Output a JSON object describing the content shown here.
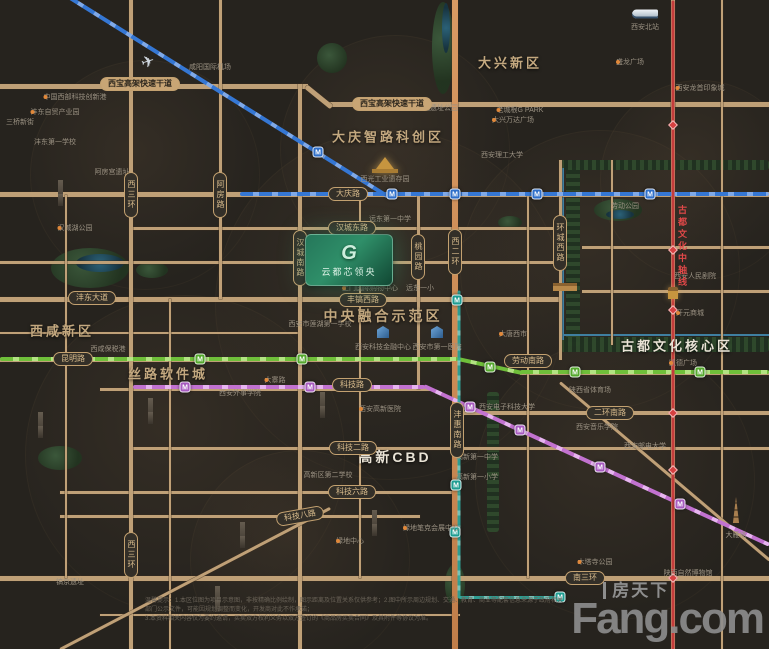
{
  "project": {
    "name": "云都芯领央",
    "emblem": "G"
  },
  "watermark": {
    "cn": "房天下",
    "en": "Fang.com"
  },
  "axis": {
    "label": "古都文化中轴线"
  },
  "disclaimer": {
    "line1": "温馨提示：1.本区位图为项目示意图，非按精确比例绘制，图示距离及位置关系仅供参考；2.图中所示周边规划、交通、教育、商业等配套信息来源于政府相关部门公示文件，可能因规划调整而变化，开发商对此不作承诺；",
    "line2": "3.本资料相关内容仅为要约邀请，买卖双方权利义务以双方签订的《商品房买卖合同》及其附件等协议为准。"
  },
  "map": {
    "bubbles": [
      {
        "x": 390,
        "y": 305,
        "r": 175
      },
      {
        "x": 185,
        "y": 455,
        "r": 160
      },
      {
        "x": 395,
        "y": 150,
        "r": 115
      },
      {
        "x": 600,
        "y": 270,
        "r": 140
      },
      {
        "x": 615,
        "y": 480,
        "r": 140
      },
      {
        "x": 145,
        "y": 175,
        "r": 115
      },
      {
        "x": 300,
        "y": 560,
        "r": 110
      },
      {
        "x": 700,
        "y": 180,
        "r": 100
      }
    ],
    "parks": [
      {
        "x": 90,
        "y": 268,
        "w": 78,
        "h": 40
      },
      {
        "x": 152,
        "y": 270,
        "w": 32,
        "h": 16
      },
      {
        "x": 332,
        "y": 58,
        "w": 30,
        "h": 30
      },
      {
        "x": 443,
        "y": 48,
        "w": 22,
        "h": 92
      },
      {
        "x": 510,
        "y": 222,
        "w": 24,
        "h": 13
      },
      {
        "x": 618,
        "y": 210,
        "w": 48,
        "h": 22
      },
      {
        "x": 60,
        "y": 458,
        "w": 44,
        "h": 24
      },
      {
        "x": 455,
        "y": 585,
        "w": 20,
        "h": 42
      }
    ],
    "bands": [
      {
        "x": 566,
        "y": 168,
        "w": 14,
        "h": 178,
        "v": true
      },
      {
        "x": 560,
        "y": 337,
        "w": 209,
        "h": 15
      },
      {
        "x": 560,
        "y": 160,
        "w": 209,
        "h": 10
      },
      {
        "x": 487,
        "y": 392,
        "w": 12,
        "h": 140,
        "v": true
      }
    ],
    "water": [
      {
        "x": 100,
        "y": 263,
        "w": 48,
        "h": 18
      },
      {
        "x": 620,
        "y": 214,
        "w": 28,
        "h": 9
      },
      {
        "x": 446,
        "y": 28,
        "w": 8,
        "h": 50
      }
    ],
    "moat": [
      {
        "x": 562,
        "y": 168,
        "w": 2,
        "h": 172
      },
      {
        "x": 560,
        "y": 334,
        "w": 209,
        "h": 2
      }
    ],
    "roads_h": [
      {
        "y": 86,
        "x1": 0,
        "x2": 308,
        "w": 5
      },
      {
        "y": 104,
        "x1": 328,
        "x2": 769,
        "w": 5
      },
      {
        "y": 194,
        "x1": 0,
        "x2": 769,
        "w": 5
      },
      {
        "y": 228,
        "x1": 131,
        "x2": 560,
        "w": 3
      },
      {
        "y": 262,
        "x1": 0,
        "x2": 560,
        "w": 3
      },
      {
        "y": 299,
        "x1": 0,
        "x2": 560,
        "w": 5
      },
      {
        "y": 247,
        "x1": 582,
        "x2": 769,
        "w": 3
      },
      {
        "y": 291,
        "x1": 582,
        "x2": 769,
        "w": 3
      },
      {
        "y": 360,
        "x1": 0,
        "x2": 460,
        "w": 4
      },
      {
        "y": 373,
        "x1": 520,
        "x2": 769,
        "w": 4
      },
      {
        "y": 389,
        "x1": 100,
        "x2": 432,
        "w": 3
      },
      {
        "y": 413,
        "x1": 455,
        "x2": 769,
        "w": 4
      },
      {
        "y": 448,
        "x1": 131,
        "x2": 769,
        "w": 3
      },
      {
        "y": 492,
        "x1": 60,
        "x2": 460,
        "w": 3
      },
      {
        "y": 516,
        "x1": 60,
        "x2": 420,
        "w": 3
      },
      {
        "y": 578,
        "x1": 0,
        "x2": 769,
        "w": 5
      },
      {
        "y": 615,
        "x1": 100,
        "x2": 460,
        "w": 2
      },
      {
        "y": 333,
        "x1": 0,
        "x2": 300,
        "w": 2
      }
    ],
    "roads_v": [
      {
        "x": 66,
        "y1": 195,
        "y2": 578,
        "w": 2
      },
      {
        "x": 131,
        "y1": 0,
        "y2": 649,
        "w": 4
      },
      {
        "x": 220,
        "y1": 0,
        "y2": 299,
        "w": 3
      },
      {
        "x": 300,
        "y1": 84,
        "y2": 649,
        "w": 4
      },
      {
        "x": 360,
        "y1": 194,
        "y2": 578,
        "w": 2
      },
      {
        "x": 418,
        "y1": 194,
        "y2": 389,
        "w": 3
      },
      {
        "x": 455,
        "y1": 0,
        "y2": 649,
        "w": 6,
        "cls": "orange"
      },
      {
        "x": 528,
        "y1": 194,
        "y2": 578,
        "w": 2
      },
      {
        "x": 560,
        "y1": 160,
        "y2": 360,
        "w": 3
      },
      {
        "x": 612,
        "y1": 160,
        "y2": 345,
        "w": 2
      },
      {
        "x": 673,
        "y1": 0,
        "y2": 649,
        "w": 4
      },
      {
        "x": 722,
        "y1": 0,
        "y2": 649,
        "w": 2
      },
      {
        "x": 170,
        "y1": 299,
        "y2": 649,
        "w": 2
      }
    ],
    "roads_d": [
      {
        "x": 306,
        "y": 86,
        "len": 33,
        "ang": 39,
        "w": 5
      },
      {
        "x": 60,
        "y": 649,
        "len": 305,
        "ang": -27.6,
        "w": 3
      },
      {
        "x": 560,
        "y": 382,
        "len": 275,
        "ang": 40.3,
        "w": 3
      }
    ],
    "metro": [
      {
        "c": "blue",
        "x": 67,
        "y": -4,
        "len": 379,
        "ang": 32,
        "w": 4
      },
      {
        "c": "blue",
        "x": 240,
        "y": 194,
        "len": 529,
        "ang": 0,
        "w": 4
      },
      {
        "c": "green",
        "x": 0,
        "y": 359,
        "len": 458,
        "ang": 0,
        "w": 4
      },
      {
        "c": "green",
        "x": 458,
        "y": 359,
        "len": 66,
        "ang": 12.3,
        "w": 4
      },
      {
        "c": "green",
        "x": 520,
        "y": 372,
        "len": 249,
        "ang": 0,
        "w": 4
      },
      {
        "c": "pink",
        "x": 133,
        "y": 387,
        "len": 292,
        "ang": 0,
        "w": 4
      },
      {
        "c": "pink",
        "x": 424,
        "y": 386,
        "len": 380,
        "ang": 24.7,
        "w": 4
      },
      {
        "c": "teal",
        "x": 459,
        "y": 290,
        "len": 308,
        "ang": 90,
        "w": 3
      },
      {
        "c": "teal",
        "x": 459,
        "y": 597,
        "len": 106,
        "ang": 0,
        "w": 3
      },
      {
        "c": "red",
        "x": 673,
        "y": 0,
        "len": 649,
        "ang": 90,
        "w": 3
      }
    ],
    "stations": [
      {
        "c": "blue",
        "x": 318,
        "y": 152
      },
      {
        "c": "blue",
        "x": 392,
        "y": 194
      },
      {
        "c": "blue",
        "x": 455,
        "y": 194
      },
      {
        "c": "blue",
        "x": 537,
        "y": 194
      },
      {
        "c": "blue",
        "x": 650,
        "y": 194
      },
      {
        "c": "green",
        "x": 200,
        "y": 359
      },
      {
        "c": "green",
        "x": 302,
        "y": 359
      },
      {
        "c": "green",
        "x": 490,
        "y": 367
      },
      {
        "c": "green",
        "x": 575,
        "y": 372
      },
      {
        "c": "green",
        "x": 700,
        "y": 372
      },
      {
        "c": "teal",
        "x": 457,
        "y": 300
      },
      {
        "c": "teal",
        "x": 456,
        "y": 485
      },
      {
        "c": "teal",
        "x": 455,
        "y": 532
      },
      {
        "c": "teal",
        "x": 560,
        "y": 597
      },
      {
        "c": "pink",
        "x": 185,
        "y": 387
      },
      {
        "c": "pink",
        "x": 310,
        "y": 387
      },
      {
        "c": "pink",
        "x": 470,
        "y": 407
      },
      {
        "c": "pink",
        "x": 520,
        "y": 430
      },
      {
        "c": "pink",
        "x": 600,
        "y": 467
      },
      {
        "c": "pink",
        "x": 680,
        "y": 504
      }
    ],
    "red_stations": [
      {
        "x": 673,
        "y": 125
      },
      {
        "x": 673,
        "y": 250
      },
      {
        "x": 673,
        "y": 310
      },
      {
        "x": 673,
        "y": 413
      },
      {
        "x": 673,
        "y": 470
      },
      {
        "x": 673,
        "y": 578
      }
    ],
    "station_glyph": "M",
    "badges": [
      {
        "t": "西宝高架快速干道",
        "x": 140,
        "y": 84,
        "fill": true
      },
      {
        "t": "西宝高架快速干道",
        "x": 392,
        "y": 104,
        "fill": true
      },
      {
        "t": "大庆路",
        "x": 348,
        "y": 194
      },
      {
        "t": "汉城东路",
        "x": 352,
        "y": 228
      },
      {
        "t": "沣东大道",
        "x": 92,
        "y": 298
      },
      {
        "t": "丰镐西路",
        "x": 363,
        "y": 300
      },
      {
        "t": "昆明路",
        "x": 73,
        "y": 359
      },
      {
        "t": "劳动南路",
        "x": 528,
        "y": 361
      },
      {
        "t": "科技路",
        "x": 352,
        "y": 385
      },
      {
        "t": "科技二路",
        "x": 353,
        "y": 448
      },
      {
        "t": "科技六路",
        "x": 352,
        "y": 492
      },
      {
        "t": "科技八路",
        "x": 300,
        "y": 516,
        "rot": -10
      },
      {
        "t": "二环南路",
        "x": 610,
        "y": 413
      },
      {
        "t": "南三环",
        "x": 585,
        "y": 578
      },
      {
        "t": "西三环",
        "x": 131,
        "y": 195,
        "v": true
      },
      {
        "t": "西三环",
        "x": 131,
        "y": 555,
        "v": true
      },
      {
        "t": "阿房路",
        "x": 220,
        "y": 195,
        "v": true
      },
      {
        "t": "汉城南路",
        "x": 300,
        "y": 258,
        "v": true
      },
      {
        "t": "桃园路",
        "x": 418,
        "y": 257,
        "v": true
      },
      {
        "t": "西二环",
        "x": 455,
        "y": 252,
        "v": true
      },
      {
        "t": "沣惠南路",
        "x": 457,
        "y": 430,
        "v": true
      },
      {
        "t": "环城西路",
        "x": 560,
        "y": 243,
        "v": true
      }
    ],
    "districts": [
      {
        "t": "大兴新区",
        "x": 510,
        "y": 62,
        "s": 13
      },
      {
        "t": "大庆智路科创区",
        "x": 388,
        "y": 136,
        "s": 13
      },
      {
        "t": "西咸新区",
        "x": 62,
        "y": 330,
        "s": 13
      },
      {
        "t": "丝路软件城",
        "x": 168,
        "y": 373,
        "s": 13
      },
      {
        "t": "中央融合示范区",
        "x": 383,
        "y": 316,
        "s": 14
      },
      {
        "t": "高新CBD",
        "x": 395,
        "y": 457,
        "s": 14,
        "white": true
      },
      {
        "t": "古都文化核心区",
        "x": 677,
        "y": 345,
        "s": 13,
        "white": true
      }
    ],
    "pois": [
      {
        "t": "咸阳国际机场",
        "x": 210,
        "y": 67
      },
      {
        "t": "西安北站",
        "x": 645,
        "y": 27
      },
      {
        "t": "中国西部科技创新港",
        "x": 75,
        "y": 97,
        "dot": true
      },
      {
        "t": "沣东自贸产业园",
        "x": 55,
        "y": 112,
        "dot": true
      },
      {
        "t": "三桥新街",
        "x": 20,
        "y": 122
      },
      {
        "t": "沣东第一学校",
        "x": 55,
        "y": 142
      },
      {
        "t": "阿房宫遗址",
        "x": 112,
        "y": 172
      },
      {
        "t": "汉城湖公园",
        "x": 75,
        "y": 228,
        "dot": true
      },
      {
        "t": "汉长安城遗址公园",
        "x": 430,
        "y": 108
      },
      {
        "t": "老城根G PARK",
        "x": 520,
        "y": 110,
        "dot": true
      },
      {
        "t": "大兴万达广场",
        "x": 513,
        "y": 120,
        "dot": true
      },
      {
        "t": "盛龙广场",
        "x": 630,
        "y": 62,
        "dot": true
      },
      {
        "t": "西安龙首印象城",
        "x": 700,
        "y": 88,
        "dot": true
      },
      {
        "t": "西安理工大学",
        "x": 502,
        "y": 155
      },
      {
        "t": "劳动公园",
        "x": 625,
        "y": 206
      },
      {
        "t": "西安人民剧院",
        "x": 695,
        "y": 276
      },
      {
        "t": "开元商城",
        "x": 690,
        "y": 313,
        "dot": true
      },
      {
        "t": "大唐西市",
        "x": 513,
        "y": 334,
        "dot": true
      },
      {
        "t": "凯德广场",
        "x": 683,
        "y": 363,
        "dot": true
      },
      {
        "t": "陕西省体育场",
        "x": 590,
        "y": 390
      },
      {
        "t": "西安邮电大学",
        "x": 645,
        "y": 446
      },
      {
        "t": "大雁塔",
        "x": 736,
        "y": 535
      },
      {
        "t": "远东第一中学",
        "x": 390,
        "y": 219
      },
      {
        "t": "西光工业遗存园",
        "x": 385,
        "y": 179
      },
      {
        "t": "土门国际购物中心",
        "x": 370,
        "y": 288,
        "dot": true
      },
      {
        "t": "远东一小",
        "x": 420,
        "y": 288
      },
      {
        "t": "西安市莲湖第一学校",
        "x": 320,
        "y": 324
      },
      {
        "t": "西安科技金融中心",
        "x": 383,
        "y": 347
      },
      {
        "t": "西安市第一医院",
        "x": 437,
        "y": 347
      },
      {
        "t": "西咸保税港",
        "x": 108,
        "y": 349
      },
      {
        "t": "大寨路",
        "x": 275,
        "y": 380,
        "dot": true
      },
      {
        "t": "西安外事学院",
        "x": 240,
        "y": 393
      },
      {
        "t": "西安电子科技大学",
        "x": 507,
        "y": 407
      },
      {
        "t": "西安高新医院",
        "x": 380,
        "y": 409,
        "dot": true
      },
      {
        "t": "西安音乐学院",
        "x": 597,
        "y": 427
      },
      {
        "t": "高新第一中学",
        "x": 477,
        "y": 457
      },
      {
        "t": "高新区第二学校",
        "x": 328,
        "y": 475
      },
      {
        "t": "高新第一小学",
        "x": 477,
        "y": 477
      },
      {
        "t": "绿地笔克会展中心",
        "x": 431,
        "y": 528,
        "dot": true
      },
      {
        "t": "绿地中心",
        "x": 350,
        "y": 541,
        "dot": true
      },
      {
        "t": "木塔寺公园",
        "x": 595,
        "y": 562,
        "dot": true
      },
      {
        "t": "陕西自然博物馆",
        "x": 688,
        "y": 573
      },
      {
        "t": "镐京遗址",
        "x": 70,
        "y": 582
      }
    ],
    "landmarks": [
      {
        "k": "plane",
        "x": 148,
        "y": 62
      },
      {
        "k": "train",
        "x": 645,
        "y": 14
      },
      {
        "k": "palace",
        "x": 385,
        "y": 163
      },
      {
        "k": "gate",
        "x": 565,
        "y": 287
      },
      {
        "k": "tower",
        "x": 673,
        "y": 293
      },
      {
        "k": "pagoda",
        "x": 736,
        "y": 510
      },
      {
        "k": "bluebldg",
        "x": 383,
        "y": 332
      },
      {
        "k": "bluebldg",
        "x": 437,
        "y": 332
      }
    ],
    "buildings": [
      {
        "x": 58,
        "y": 206
      },
      {
        "x": 148,
        "y": 424
      },
      {
        "x": 38,
        "y": 438
      },
      {
        "x": 320,
        "y": 418
      },
      {
        "x": 372,
        "y": 536
      },
      {
        "x": 240,
        "y": 548
      },
      {
        "x": 215,
        "y": 612
      }
    ]
  }
}
